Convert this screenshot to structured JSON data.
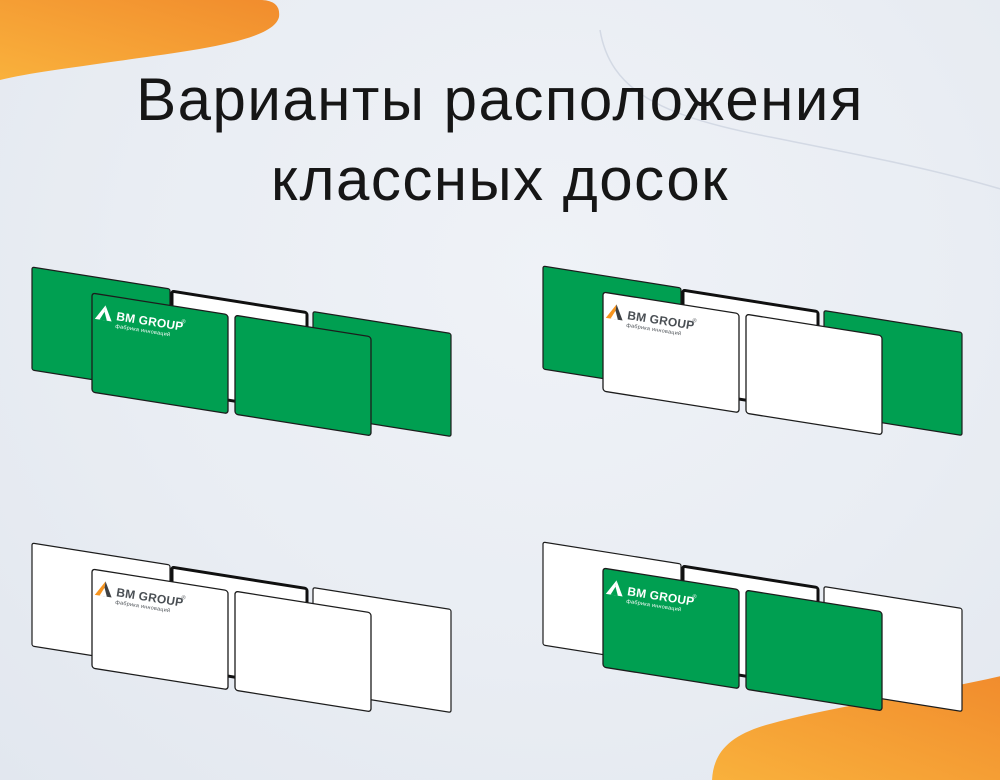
{
  "title": {
    "line1": "Варианты расположения",
    "line2": "классных досок"
  },
  "logo": {
    "name": "BM GROUP",
    "registered": "®",
    "tagline": "фабрика инноваций"
  },
  "colors": {
    "board_green": "#009F51",
    "board_white": "#FFFFFF",
    "panel_outline": "#1C1C1C",
    "frame_outline": "#101010",
    "background": "#E9EDF3",
    "title_text": "#161616",
    "orange_light": "#F9B13C",
    "orange_dark": "#F18C2D",
    "arc_line": "#D3D9E4",
    "logo_orange": "#F7941E",
    "logo_dark_gray": "#3E4043",
    "logo_text_dark": "#4A4F54",
    "logo_white": "#FFFFFF"
  },
  "variants": [
    {
      "id": "green-wings-green-doors",
      "wing_fill": "#009F51",
      "door_fill": "#009F51",
      "logo_tri_left": "#FFFFFF",
      "logo_tri_right": "#FFFFFF",
      "logo_text_fill": "#FFFFFF"
    },
    {
      "id": "green-wings-white-doors",
      "wing_fill": "#009F51",
      "door_fill": "#FFFFFF",
      "logo_tri_left": "#F7941E",
      "logo_tri_right": "#3E4043",
      "logo_text_fill": "#4A4F54"
    },
    {
      "id": "white-wings-white-doors",
      "wing_fill": "#FFFFFF",
      "door_fill": "#FFFFFF",
      "logo_tri_left": "#F7941E",
      "logo_tri_right": "#3E4043",
      "logo_text_fill": "#4A4F54"
    },
    {
      "id": "white-wings-green-doors",
      "wing_fill": "#FFFFFF",
      "door_fill": "#009F51",
      "logo_tri_left": "#FFFFFF",
      "logo_tri_right": "#FFFFFF",
      "logo_text_fill": "#FFFFFF"
    }
  ]
}
